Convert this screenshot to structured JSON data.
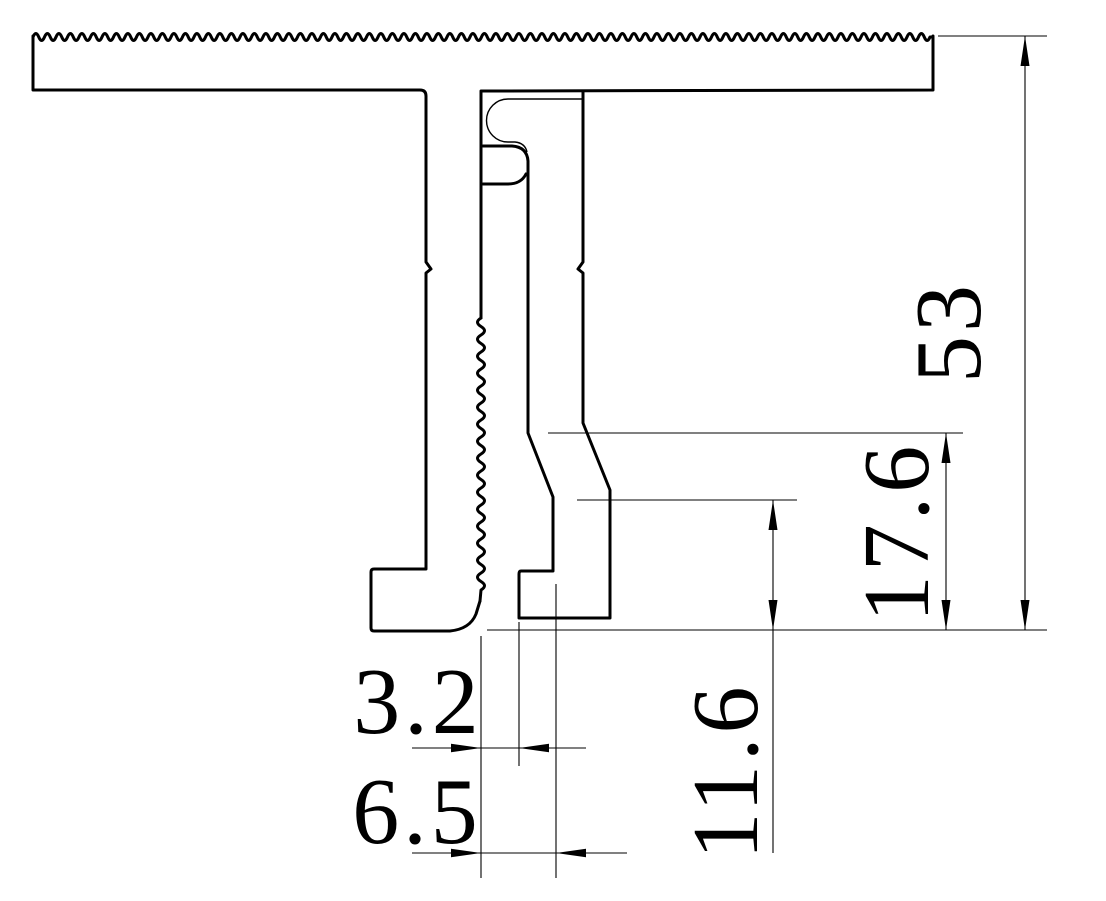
{
  "drawing": {
    "type": "technical-cross-section",
    "colors": {
      "line": "#000000",
      "background": "#ffffff"
    },
    "dimensions": {
      "overall_height": "53",
      "upper_step_height": "17.6",
      "lower_step_height": "11.6",
      "slot_width": "3.2",
      "slot_mouth_width": "6.5"
    }
  }
}
